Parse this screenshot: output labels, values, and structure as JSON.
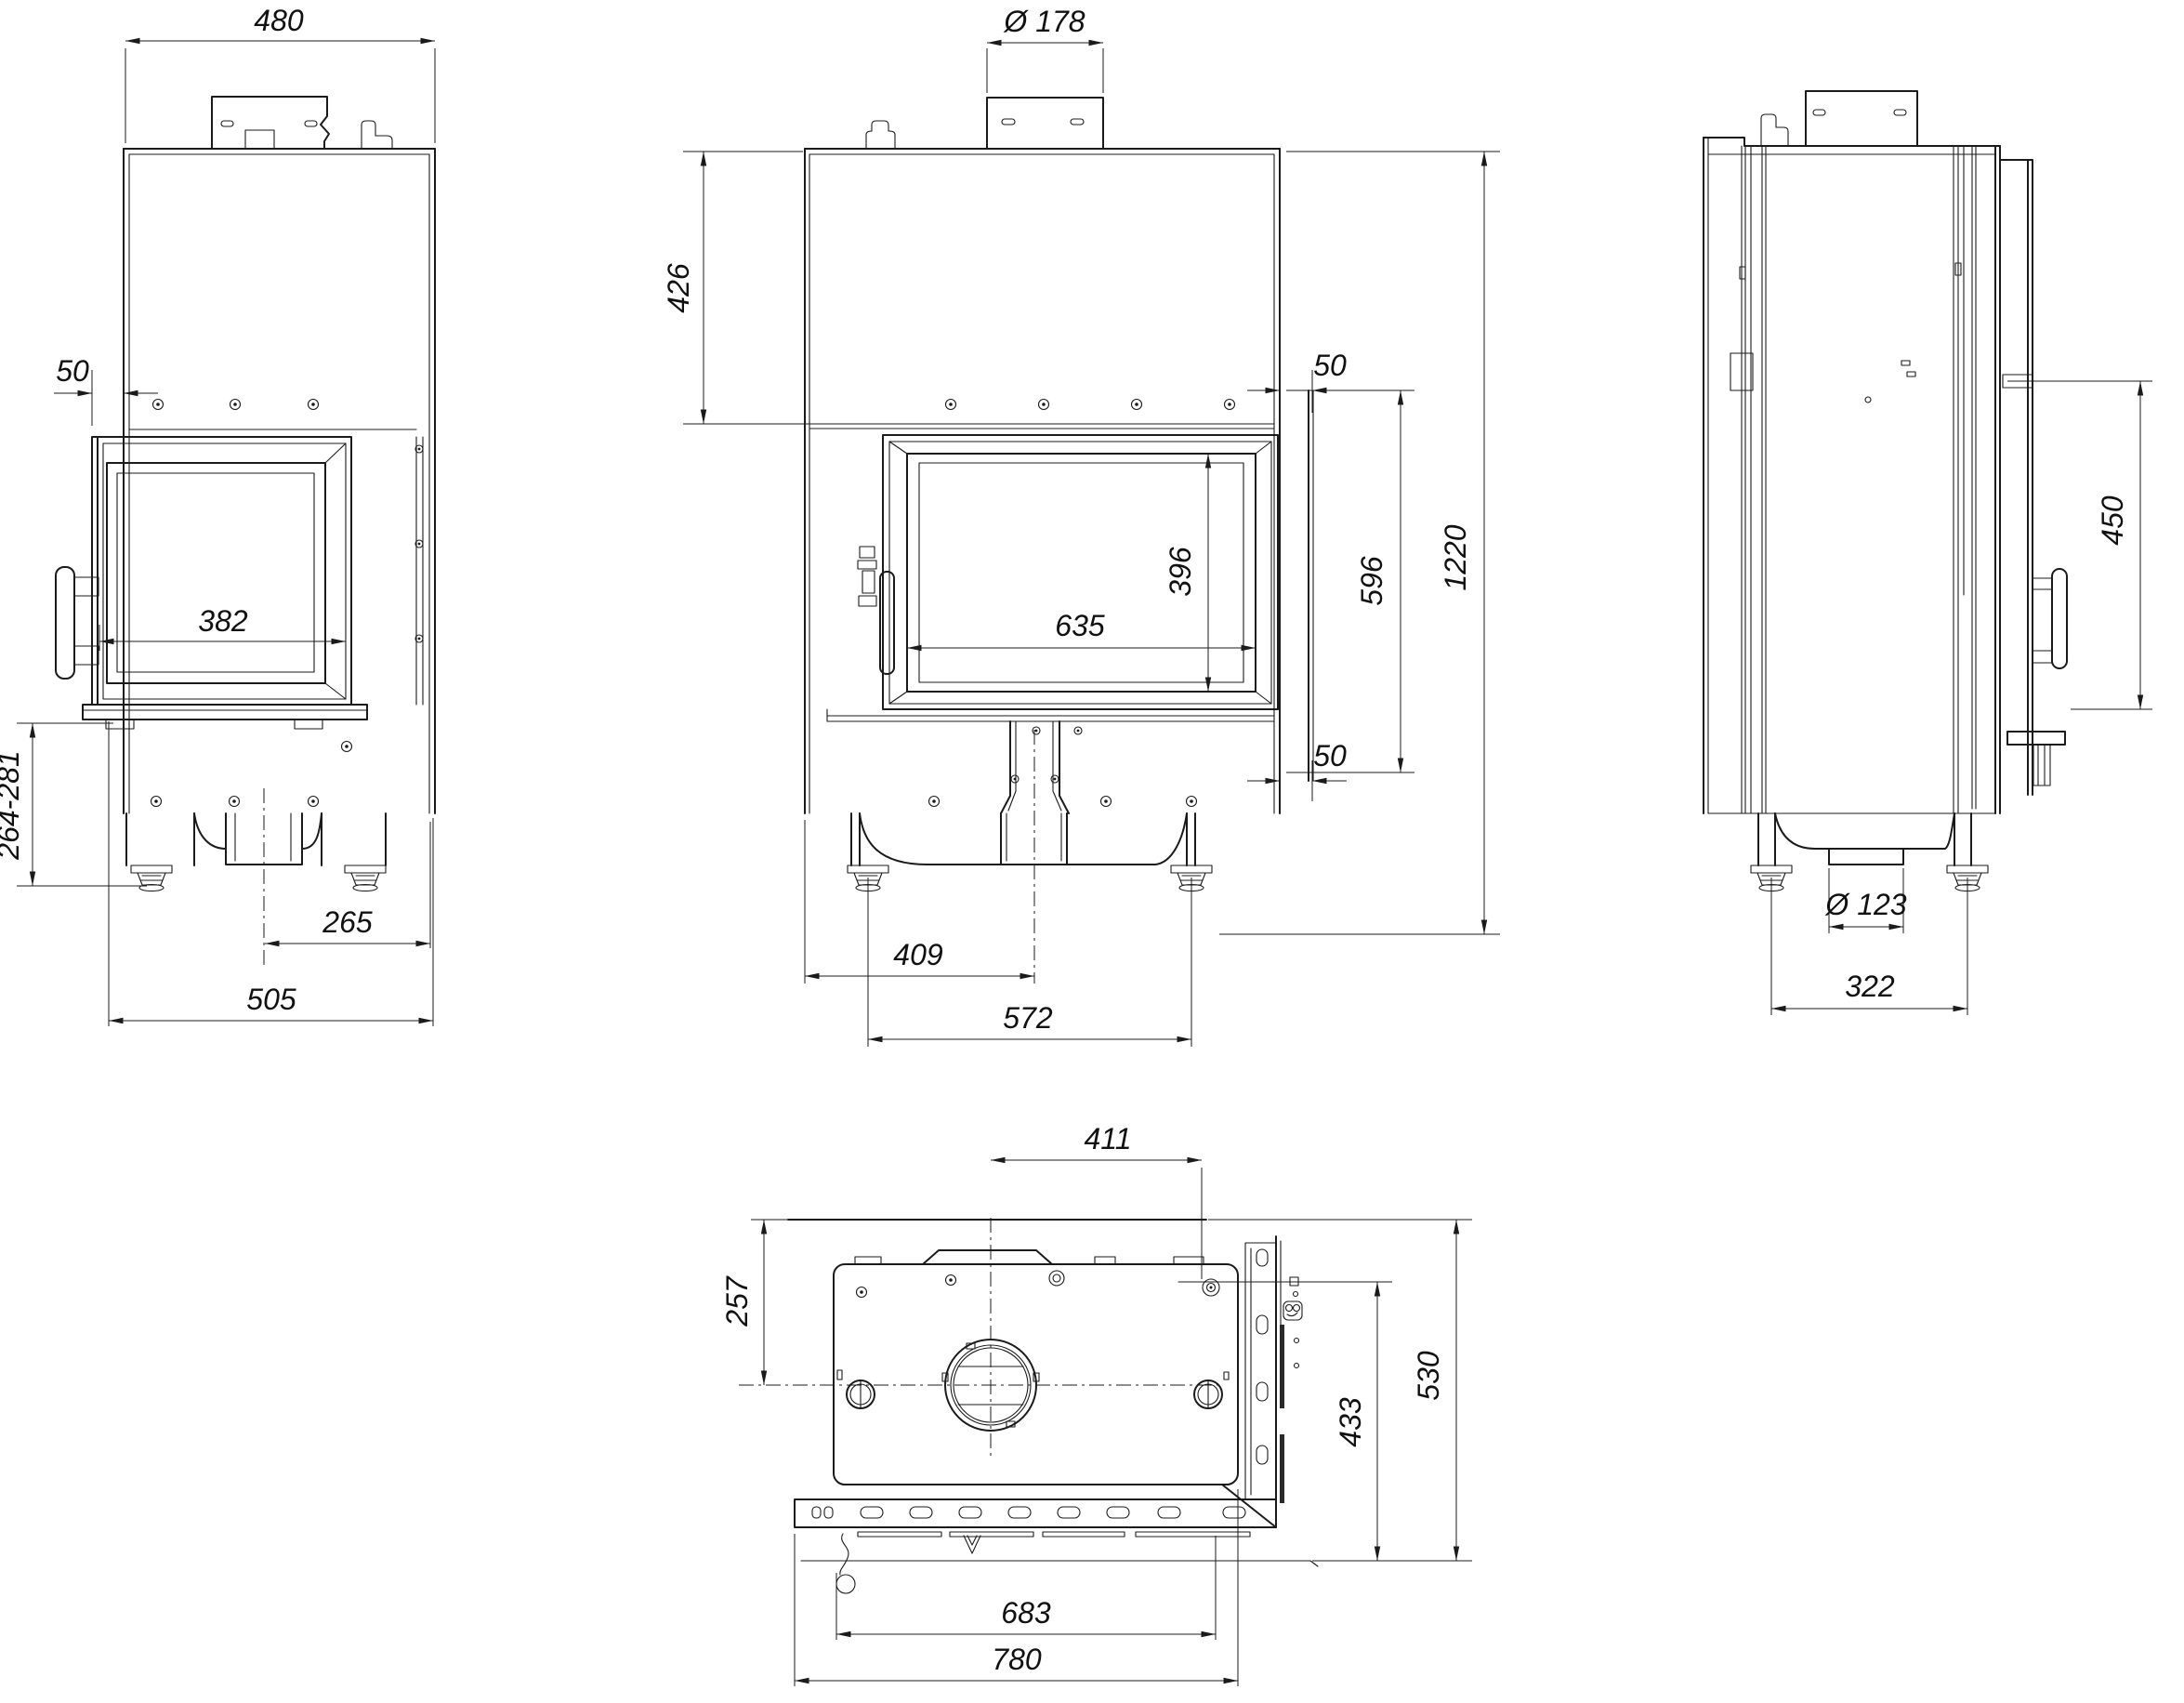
{
  "dimensions": {
    "side_a": {
      "top_width": "480",
      "front_offset": "50",
      "glass_width": "382",
      "base_height_range": "264-281",
      "outlet_to_edge": "265",
      "total_depth": "505"
    },
    "front": {
      "flue_diameter": "Ø 178",
      "top_to_door": "426",
      "top_inset": "50",
      "door_glass_height_side": "596",
      "glass_width": "635",
      "glass_height": "396",
      "total_height": "1220",
      "bottom_inset": "50",
      "edge_to_center": "409",
      "feet_spacing": "572"
    },
    "side_b": {
      "door_glass_height": "450",
      "outlet_diameter": "Ø 123",
      "feet_spacing": "322"
    },
    "top": {
      "center_to_side": "411",
      "back_to_center": "257",
      "inner_depth": "433",
      "total_depth": "530",
      "inner_width": "683",
      "total_width": "780"
    }
  }
}
